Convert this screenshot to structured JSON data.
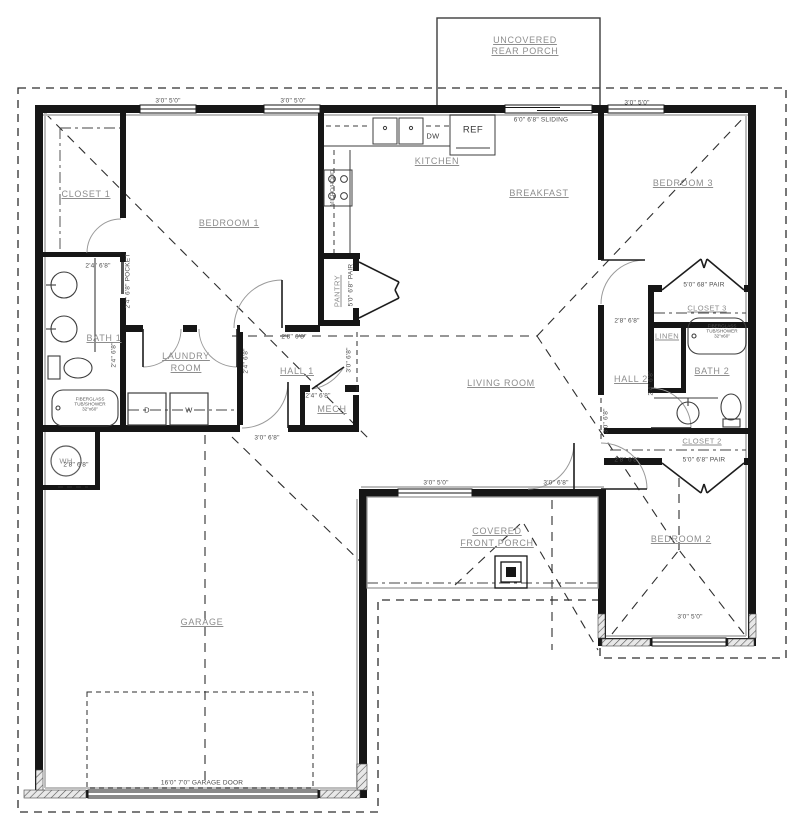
{
  "colors": {
    "wall": "#161616",
    "wall_face": "#bdbdbd",
    "thin_line": "#3d3d3d",
    "arc": "#9a9a9a",
    "room_label": "#8d8d8d",
    "dim_label": "#4c4c4c",
    "background": "#ffffff"
  },
  "rooms": {
    "rear_porch_line1": "UNCOVERED",
    "rear_porch_line2": "REAR PORCH",
    "closet1": "CLOSET 1",
    "bedroom1": "BEDROOM 1",
    "kitchen": "KITCHEN",
    "breakfast": "BREAKFAST",
    "bedroom3": "BEDROOM 3",
    "bath1": "BATH 1",
    "laundry_line1": "LAUNDRY",
    "laundry_line2": "ROOM",
    "hall1": "HALL 1",
    "mech": "MECH",
    "living": "LIVING ROOM",
    "hall2": "HALL 2",
    "linen": "LINEN",
    "bath2": "BATH 2",
    "closet3": "CLOSET 3",
    "closet2": "CLOSET 2",
    "bedroom2": "BEDROOM 2",
    "front_porch_line1": "COVERED",
    "front_porch_line2": "FRONT PORCH",
    "garage": "GARAGE"
  },
  "fixtures": {
    "dw": "DW",
    "ref": "REF",
    "dryer": "D",
    "washer": "W",
    "water_heater": "WH",
    "range_hood": "MICRO/HOOD",
    "pantry": "PANTRY",
    "tub_line1": "FIBERGLASS",
    "tub_line2": "TUB/SHOWER",
    "tub_line3": "32\"x60\""
  },
  "dims": {
    "win_3050": "3'0\" 5'0\"",
    "door_2468": "2'4\" 6'8\"",
    "door_2868": "2'8\" 6'8\"",
    "door_3068": "3'0\" 6'8\"",
    "sliding": "6'0\" 6'8\" SLIDING",
    "pocket": "2'4\" 6'8\" POCKET",
    "pantry_pair": "5'0\" 6'8\" PAIR",
    "closet3_pair": "5'0\" 68\" PAIR",
    "closet2_pair": "5'0\" 6'8\" PAIR",
    "garage_door": "16'0\" 7'0\" GARAGE DOOR"
  }
}
